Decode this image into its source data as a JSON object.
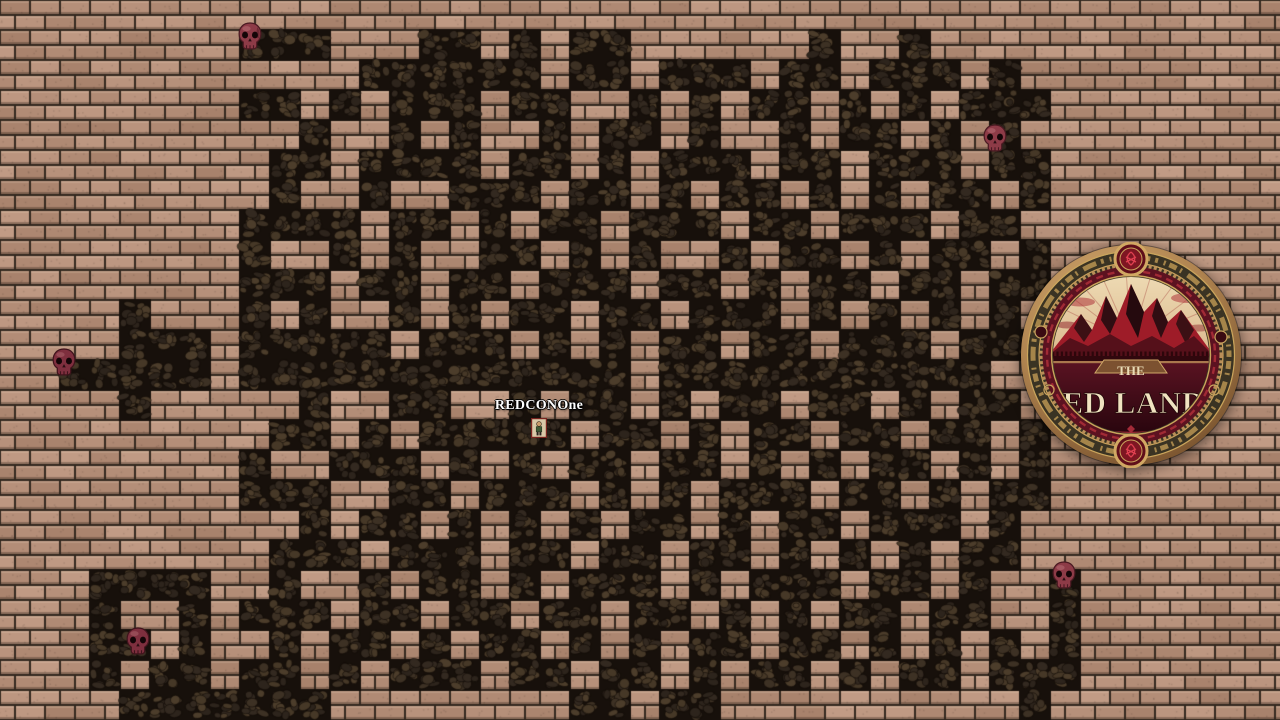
{
  "screen": {
    "width": 1280,
    "height": 720
  },
  "game": {
    "player": {
      "name": "REDCONOne",
      "x": 539,
      "y": 398,
      "sprite_x": 531,
      "sprite_y": 418
    },
    "skulls": [
      {
        "id": "skull-top-left",
        "x": 236,
        "y": 22
      },
      {
        "id": "skull-top-right",
        "x": 981,
        "y": 124
      },
      {
        "id": "skull-mid-left",
        "x": 50,
        "y": 348
      },
      {
        "id": "skull-bottom-right",
        "x": 1050,
        "y": 561
      },
      {
        "id": "skull-bottom-left",
        "x": 124,
        "y": 627
      }
    ],
    "logo": {
      "x": 1018,
      "y": 242,
      "size": 226,
      "title_top": "THE",
      "title_main": "RED LANDS"
    },
    "maze": {
      "tile_size": 30,
      "cols": 43,
      "rows": 24,
      "grid": [
        "...........................................",
        "........###...##.#.##......#..#............",
        "............######.##.###.##.###.#.........",
        "........##.#.###.##..#.#.##.#.#.###........",
        "..........#..#.#..#.##.#..#.##.#.#.........",
        ".........##.####.##.#.###.##.###.##........",
        ".........#..#..###.##.#.##.#.#.##.#........",
        "........####.##.#.##.###.##.###.##.........",
        "........#..#.#..##.#.#..#.##.#.##.#........",
        "........###.##.##.###.##.#.##.##.##........",
        "....#...#.#..#.#.##.##.###.#.#.#.#.........",
        "....###.#####.###.#.#.##.##.###.###........",
        "..#####.#############.###########..........",
        "....#.....#..##..#.##.#.##.##.#.##.........",
        ".........##.#.#####.##.#.##.##.##.#........",
        "........#..###.#.#.##.##.#.#.##.#.#........",
        "........###..##.###.#.#.###.##.#.##........",
        "..........#.##.#.#.#.##.#.##.###.#.........",
        ".........###.###.##.##.##.#.#.#.##.........",
        "...####..#..#.##.#.###.#.###.##.#..#.......",
        "...#..#.###.##.##.##.##.#.#.##.##..#.......",
        "...##.#..#.##.#.##.#.#.##.##.#.#.#.#.......",
        "...#.##.##.#.###.##.##.#.##.#.##.###.......",
        "....#######........##.##..........#........"
      ]
    },
    "palette": {
      "mortar": "#33281f",
      "brick_base": "#b48e78",
      "brick_highlight": "#cfa98e",
      "brick_shadow": "#23170f",
      "path_base": "#17100b",
      "cobble_1": "#3d3124",
      "cobble_2": "#463827",
      "cobble_3": "#332920",
      "cobble_4": "#4c3d2b",
      "cobble_5": "#2d241c",
      "skull_body": "#8d3b47",
      "skull_dark": "#4a1a22",
      "logo_bronze": "#b08450",
      "logo_band": "#3a3323",
      "logo_gold": "#caa55c",
      "logo_mountain": "#9e1c28",
      "logo_field": "#521020",
      "logo_cream": "#f0e3c0"
    }
  }
}
